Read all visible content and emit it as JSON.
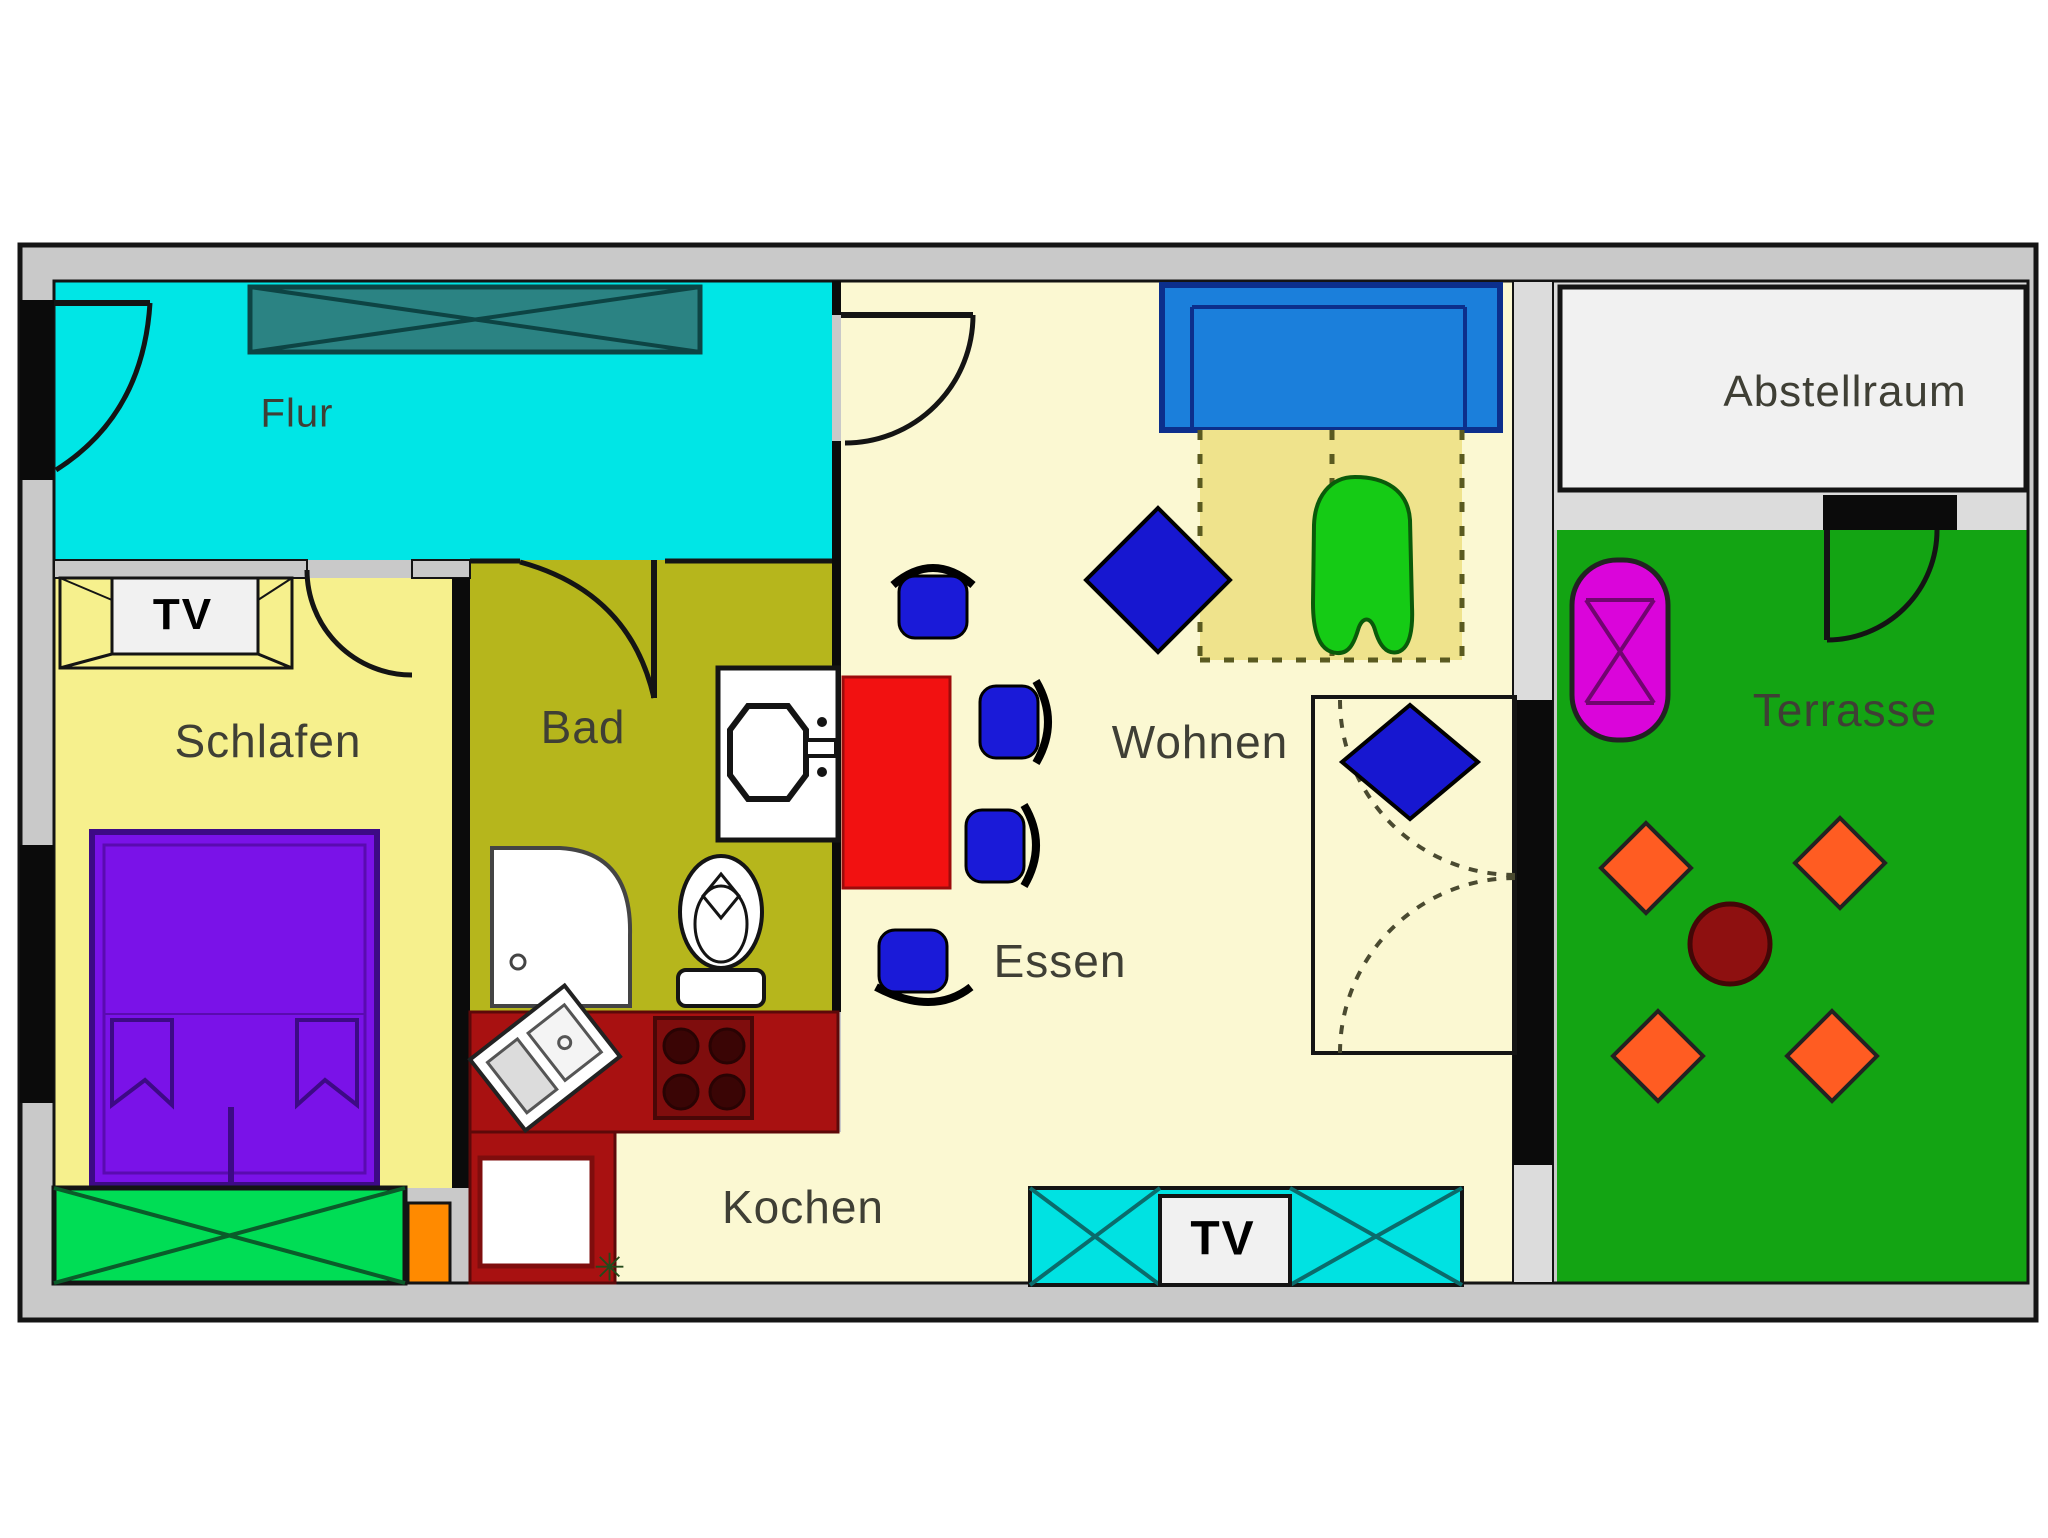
{
  "page": {
    "background": "#ffffff",
    "type": "apartment floor plan"
  },
  "palette": {
    "wall_gray": "#c9c9c9",
    "wall_light": "#dcdcdc",
    "wall_black": "#0b0b0b",
    "line_dark": "#141414",
    "flur_cyan": "#00e6e6",
    "wardrobe_teal": "#2b8383",
    "wardrobe_line": "#0d4444",
    "schlafen_yellow": "#f6f08d",
    "living_cream": "#fbf8d2",
    "foldout_yellow": "#efe38c",
    "bad_olive": "#b6b61c",
    "bed_purple": "#7a12e8",
    "bed_dark": "#3d0a85",
    "window_green": "#00dd55",
    "accent_orange": "#ff8a00",
    "counter_red": "#a81111",
    "stove_red": "#7f0d0d",
    "burner_dark": "#3a0505",
    "table_red": "#f21111",
    "chair_blue": "#1a1ad8",
    "diamond_blue": "#1717d0",
    "sofa_blue": "#1b7fdb",
    "sofa_dark": "#0c2f8c",
    "blob_green": "#15cb15",
    "terrace_green": "#13a413",
    "lounger_magenta": "#da05da",
    "lounger_dark": "#70066f",
    "terrace_diamond_orange": "#ff5c22",
    "terrace_table_red": "#8e1010",
    "sideboard_cyan": "#00e2e2",
    "sideboard_dark": "#0b6b6b",
    "fixture_white": "#ffffff",
    "tv_bg": "#f1f1f1",
    "abstell_bg": "#f1f1f1",
    "label": "#3f3f35",
    "label_black": "#000000",
    "plant_green": "#234a1a"
  },
  "rooms": {
    "flur": {
      "label": "Flur"
    },
    "schlafen": {
      "label": "Schlafen"
    },
    "bad": {
      "label": "Bad"
    },
    "kochen": {
      "label": "Kochen"
    },
    "essen": {
      "label": "Essen"
    },
    "wohnen": {
      "label": "Wohnen"
    },
    "abstellraum": {
      "label": "Abstellraum"
    },
    "terrasse": {
      "label": "Terrasse"
    }
  },
  "furniture": {
    "tv_schlafen_label": "TV",
    "tv_wohnen_label": "TV",
    "plant_marker": "✳"
  }
}
